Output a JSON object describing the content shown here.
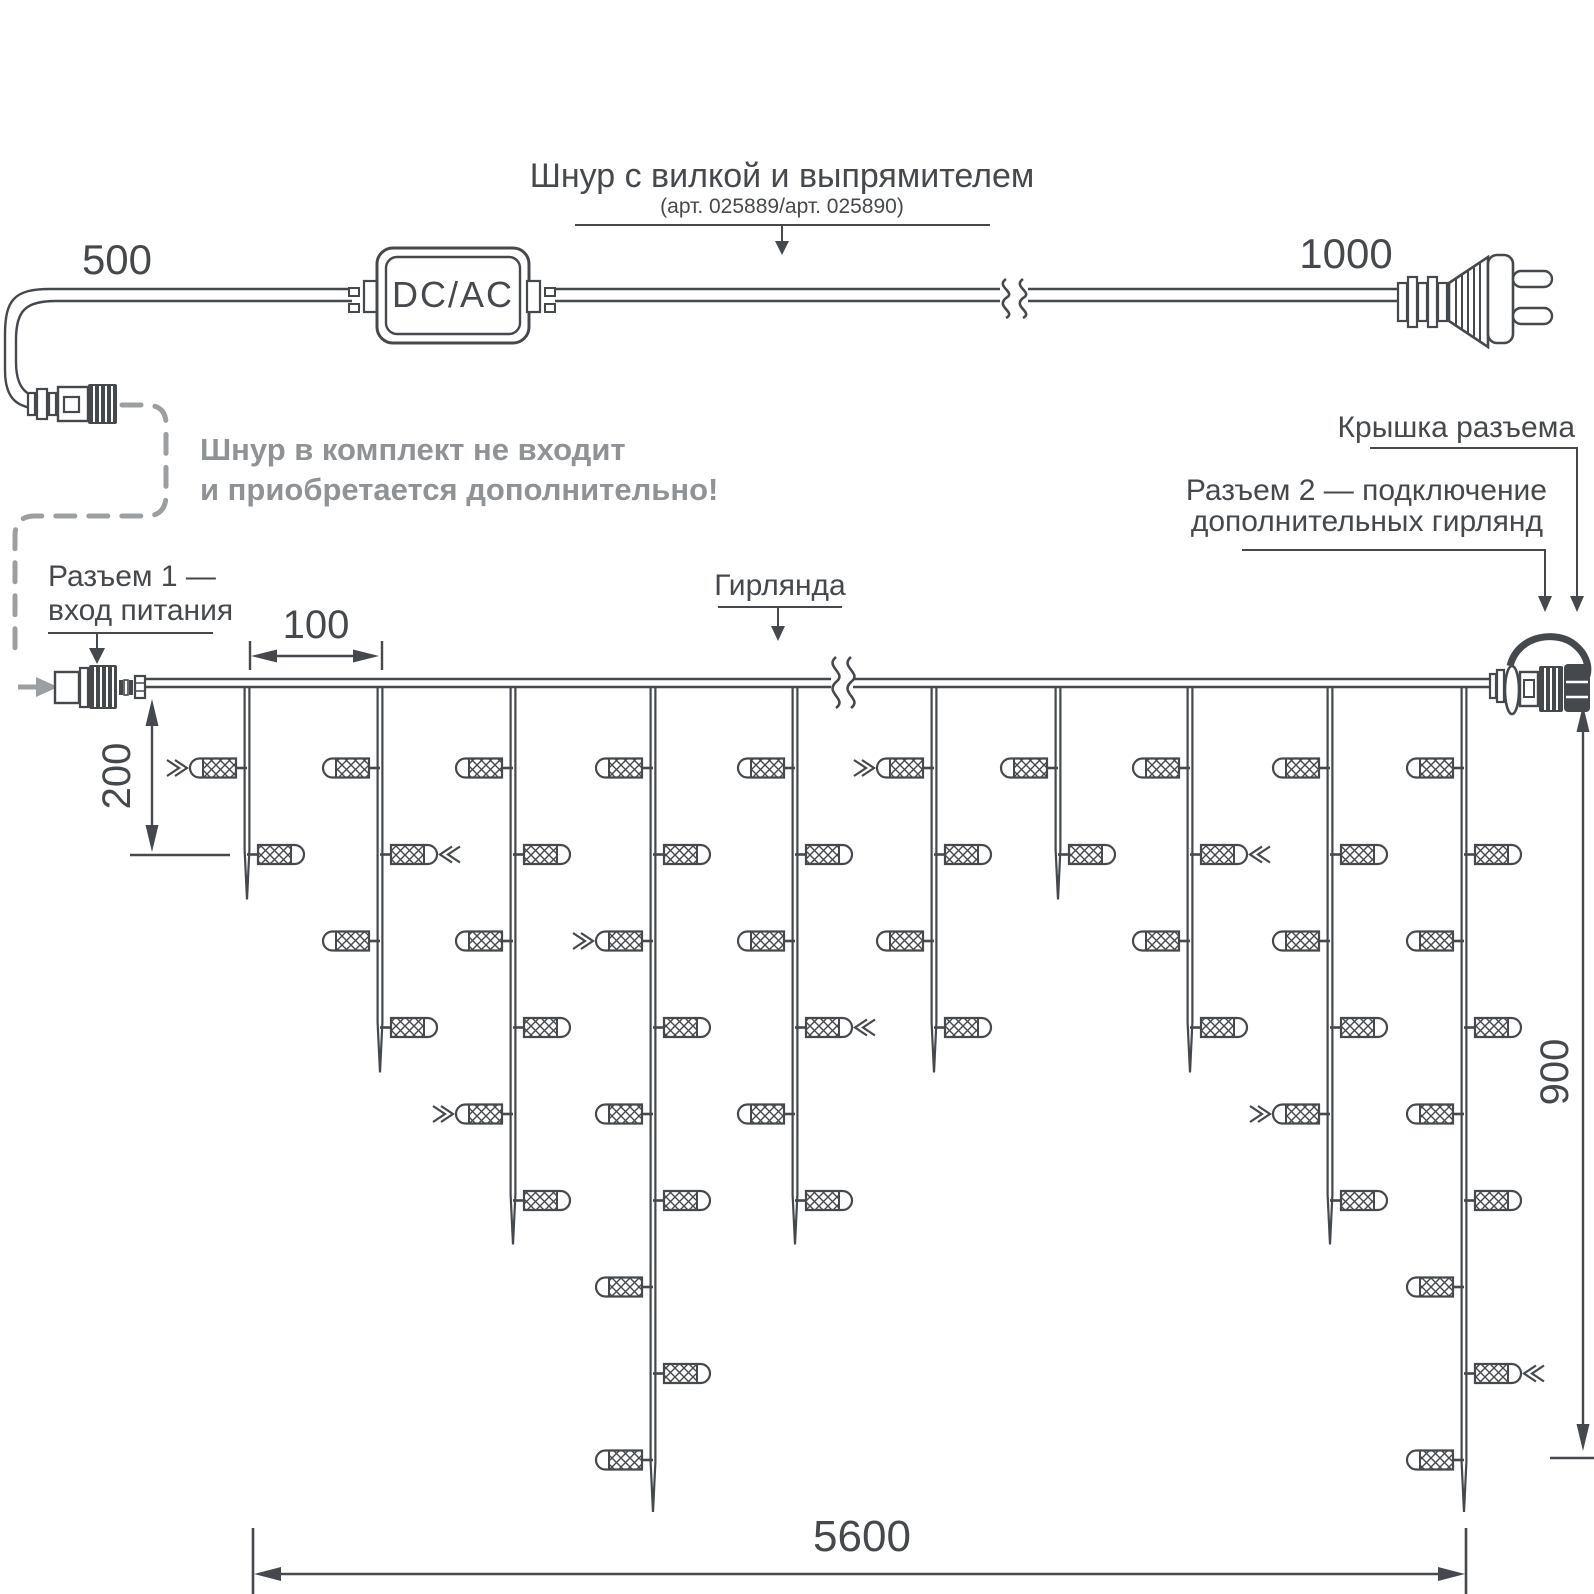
{
  "colors": {
    "ink": "#45494d",
    "muted": "#9b9fa2",
    "note_gray": "#8f9396",
    "background": "#ffffff"
  },
  "header": {
    "title": "Шнур с вилкой и выпрямителем",
    "subtitle": "(арт. 025889/арт. 025890)",
    "dim_cord_left": "500",
    "dim_cord_right": "1000",
    "converter_label": "DC/AC",
    "note_line1": "Шнур в комплект не входит",
    "note_line2": "и приобретается дополнительно!"
  },
  "labels": {
    "connector1_line1": "Разъем 1 —",
    "connector1_line2": "вход питания",
    "garland": "Гирлянда",
    "connector_cap": "Крышка разъема",
    "connector2_line1": "Разъем 2 — подключение",
    "connector2_line2": "дополнительных гирлянд"
  },
  "dimensions": {
    "drop_spacing": "100",
    "bulb_spacing": "200",
    "drop_height": "900",
    "total_length": "5600"
  },
  "garland": {
    "wire_x1": 143,
    "wire_x2": 1492,
    "wire_y_top": 679,
    "wire_y_bottom": 687,
    "break_gap": [
      831,
      853
    ],
    "first_row_y": 768,
    "row_spacing": 86.5,
    "tip_extension": {
      "2": 45,
      "4": 45,
      "6": 44,
      "9": 52
    },
    "drops": [
      {
        "x": 247,
        "bulbs": 2
      },
      {
        "x": 380,
        "bulbs": 4
      },
      {
        "x": 513,
        "bulbs": 6
      },
      {
        "x": 653,
        "bulbs": 9
      },
      {
        "x": 795,
        "bulbs": 6
      },
      {
        "x": 934,
        "bulbs": 4
      },
      {
        "x": 1058,
        "bulbs": 2
      },
      {
        "x": 1190,
        "bulbs": 4
      },
      {
        "x": 1330,
        "bulbs": 6
      },
      {
        "x": 1464,
        "bulbs": 9
      }
    ],
    "chevrons": [
      {
        "drop": 0,
        "row": 1,
        "dir": "right"
      },
      {
        "drop": 1,
        "row": 2,
        "dir": "left"
      },
      {
        "drop": 2,
        "row": 5,
        "dir": "right"
      },
      {
        "drop": 3,
        "row": 3,
        "dir": "right"
      },
      {
        "drop": 4,
        "row": 4,
        "dir": "left"
      },
      {
        "drop": 5,
        "row": 1,
        "dir": "right"
      },
      {
        "drop": 7,
        "row": 2,
        "dir": "left"
      },
      {
        "drop": 8,
        "row": 5,
        "dir": "right"
      },
      {
        "drop": 9,
        "row": 8,
        "dir": "left"
      }
    ]
  }
}
